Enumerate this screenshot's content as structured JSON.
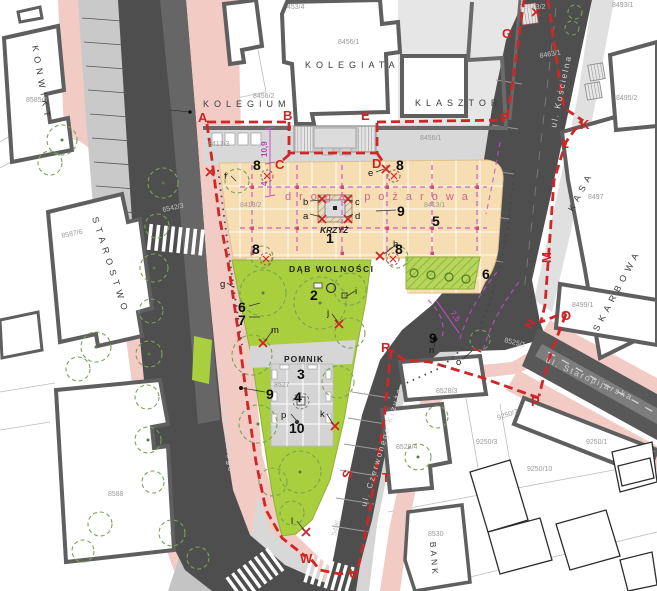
{
  "buildings": {
    "konwikt": "KONWIKT",
    "kolegium": "KOLEGIUM",
    "kolegiata": "KOLEGIATA",
    "klasztor": "KLASZTOR",
    "starostwo": "STAROSTWO",
    "kasa": "KASA",
    "skarbowa": "SKARBOWA",
    "bank": "BANK"
  },
  "streets": {
    "koscielna": "ul. Kościelna",
    "staropijarska": "ul. Staropijarska",
    "czerwonego_krzyza": "ul. Czerwonego Krzyża",
    "pilsudskiego": "ul. J. Piłsudskiego"
  },
  "features": {
    "fire_road": "droga pożarowa",
    "cross": "KRZYŻ",
    "oak": "DĄB WOLNOŚCI",
    "monument": "POMNIK"
  },
  "dimensions": {
    "d1": "10,9",
    "d2": "4",
    "d3": "7,5"
  },
  "boundary_points": {
    "A": "A",
    "B": "B",
    "C": "C",
    "D": "D",
    "E": "E",
    "F": "F",
    "G": "G",
    "K": "K",
    "L": "L",
    "M": "M",
    "N": "N",
    "O": "O",
    "P": "P",
    "R": "R",
    "S": "S",
    "T": "T",
    "U": "U",
    "W": "W"
  },
  "zones": {
    "z1": "1",
    "z2": "2",
    "z3": "3",
    "z4": "4",
    "z5": "5",
    "z6": "6",
    "z7": "7",
    "z8": "8",
    "z9": "9",
    "z10": "10"
  },
  "marks": {
    "a": "a",
    "b": "b",
    "c": "c",
    "d": "d",
    "e": "e",
    "f": "f",
    "g": "g",
    "h": "h",
    "i": "i",
    "j": "j",
    "k": "k",
    "l": "l",
    "m": "m",
    "n": "n",
    "o": "o",
    "p": "p"
  },
  "parcels": {
    "p453_4": "453/4",
    "p8456_1": "8456/1",
    "p8456_2": "8456/2",
    "p8413_1": "8413/1",
    "p8413_2": "8413/2",
    "p8413_3": "8413/3",
    "p8463_1": "8463/1",
    "p8463_2": "8463/2",
    "p8493_1": "8493/1",
    "p8495_2": "8495/2",
    "p8497": "8497",
    "p8499_1": "8499/1",
    "p8525_1": "8525/1",
    "p8527": "8527",
    "p8528_3": "8528/3",
    "p8528_4": "8528/4",
    "p8530": "8530",
    "p8585_4": "8585/4",
    "p8587_6": "8587/6",
    "p8588": "8588",
    "p6542_3": "6542/3",
    "p5496": "5496",
    "p9250_1": "9250/1",
    "p9250_3": "9250/3",
    "p9250_7": "9250/7",
    "p9250_10": "9250/10"
  },
  "colors": {
    "boundary_red": "#cc2424",
    "fire_road_magenta": "#c94fc9",
    "plaza_tan": "#f6deb2",
    "park_green": "#a9cf3e",
    "road_dark": "#4e4e4e",
    "sidewalk_pink": "#f2cbc5"
  }
}
